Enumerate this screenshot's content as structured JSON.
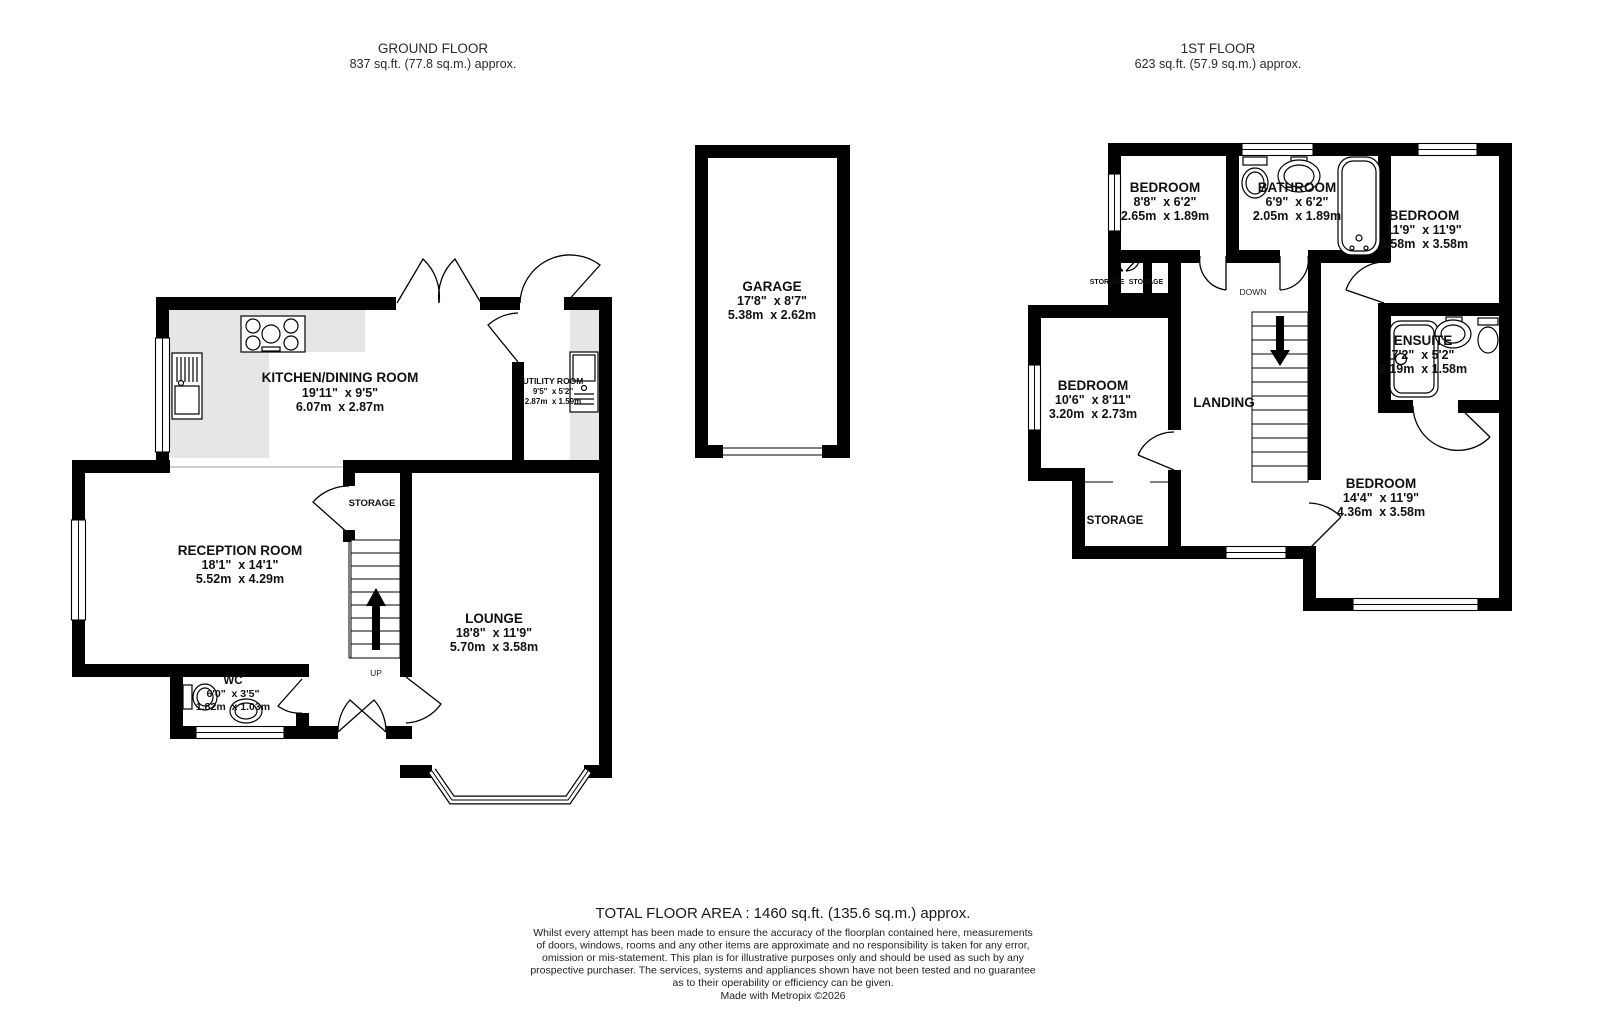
{
  "ground": {
    "title": "GROUND FLOOR",
    "area": "837 sq.ft. (77.8 sq.m.) approx.",
    "kitchen": {
      "name": "KITCHEN/DINING ROOM",
      "imperial": "19'11\"  x 9'5\"",
      "metric": "6.07m  x 2.87m"
    },
    "utility": {
      "name": "UTILITY ROOM",
      "imperial": "9'5\"  x 5'2\"",
      "metric": "2.87m  x 1.59m"
    },
    "reception": {
      "name": "RECEPTION ROOM",
      "imperial": "18'1\"  x 14'1\"",
      "metric": "5.52m  x 4.29m"
    },
    "lounge": {
      "name": "LOUNGE",
      "imperial": "18'8\"  x 11'9\"",
      "metric": "5.70m  x 3.58m"
    },
    "wc": {
      "name": "WC",
      "imperial": "6'0\"  x 3'5\"",
      "metric": "1.82m  x 1.03m"
    },
    "storage": "STORAGE",
    "up": "UP"
  },
  "garage": {
    "name": "GARAGE",
    "imperial": "17'8\"  x 8'7\"",
    "metric": "5.38m  x 2.62m"
  },
  "first": {
    "title": "1ST FLOOR",
    "area": "623 sq.ft. (57.9 sq.m.) approx.",
    "bedroom_top_left": {
      "name": "BEDROOM",
      "imperial": "8'8\"  x 6'2\"",
      "metric": "2.65m  x 1.89m"
    },
    "bathroom": {
      "name": "BATHROOM",
      "imperial": "6'9\"  x 6'2\"",
      "metric": "2.05m  x 1.89m"
    },
    "bedroom_top_right": {
      "name": "BEDROOM",
      "imperial": "11'9\"  x 11'9\"",
      "metric": "3.58m  x 3.58m"
    },
    "ensuite": {
      "name": "ENSUITE",
      "imperial": "7'2\"  x 5'2\"",
      "metric": "2.19m  x 1.58m"
    },
    "bedroom_mid_left": {
      "name": "BEDROOM",
      "imperial": "10'6\"  x 8'11\"",
      "metric": "3.20m  x 2.73m"
    },
    "bedroom_bottom_right": {
      "name": "BEDROOM",
      "imperial": "14'4\"  x 11'9\"",
      "metric": "4.36m  x 3.58m"
    },
    "landing": "LANDING",
    "storage": "STORAGE",
    "storage_small_a": "STORAGE",
    "storage_small_b": "STORAGE",
    "down": "DOWN"
  },
  "footer": {
    "total": "TOTAL FLOOR AREA : 1460 sq.ft. (135.6 sq.m.) approx.",
    "disclaimer": [
      "Whilst every attempt has been made to ensure the accuracy of the floorplan contained here, measurements",
      "of doors, windows, rooms and any other items are approximate and no responsibility is taken for any error,",
      "omission or mis-statement. This plan is for illustrative purposes only and should be used as such by any",
      "prospective purchaser. The services, systems and appliances shown have not been tested and no guarantee",
      "as to their operability or efficiency can be given."
    ],
    "credit": "Made with Metropix ©2026"
  }
}
